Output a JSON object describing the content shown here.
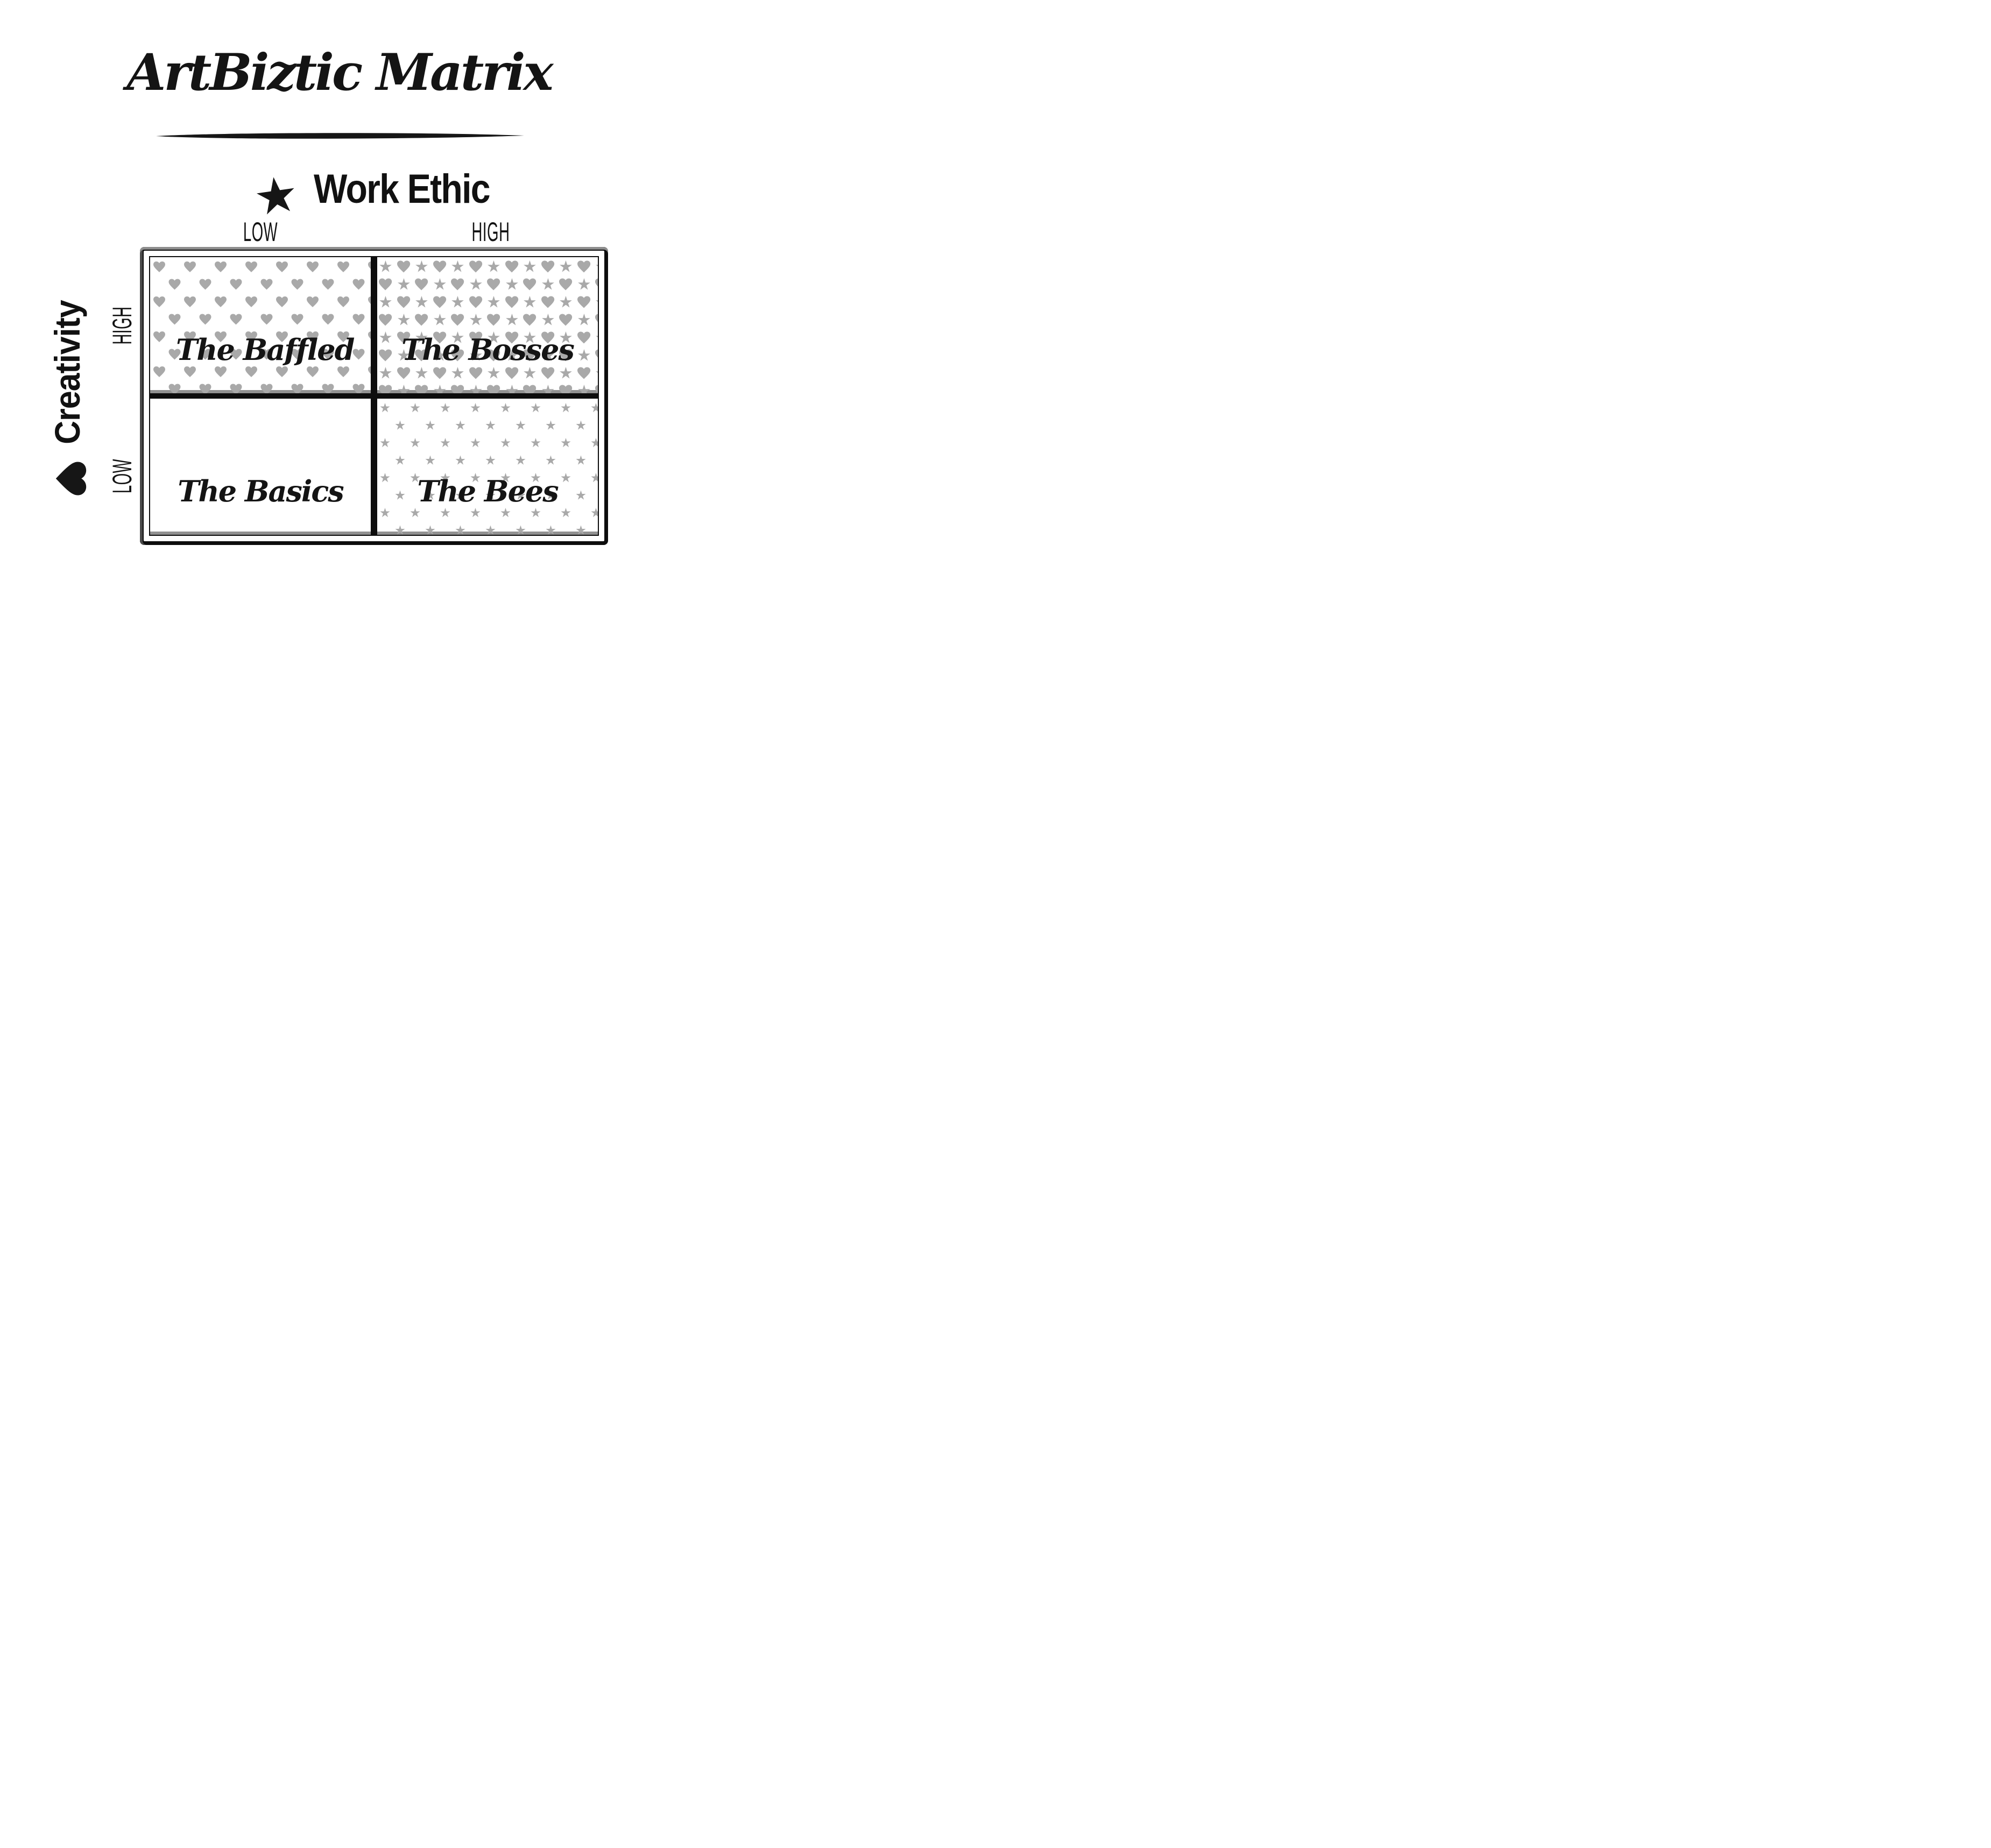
{
  "title": "ArtBiztic Matrix",
  "axes": {
    "x": {
      "title": "Work Ethic",
      "icon": "star",
      "low_label": "LOW",
      "high_label": "HIGH"
    },
    "y": {
      "title": "Creativity",
      "icon": "heart",
      "low_label": "LOW",
      "high_label": "HIGH"
    }
  },
  "quadrants": [
    {
      "name": "The Baffled",
      "position": "top-left",
      "work_ethic": "LOW",
      "creativity": "HIGH",
      "pattern": "hearts"
    },
    {
      "name": "The Bosses",
      "position": "top-right",
      "work_ethic": "HIGH",
      "creativity": "HIGH",
      "pattern": "hearts-and-stars"
    },
    {
      "name": "The Basics",
      "position": "bottom-left",
      "work_ethic": "LOW",
      "creativity": "LOW",
      "pattern": "plain"
    },
    {
      "name": "The Bees",
      "position": "bottom-right",
      "work_ethic": "HIGH",
      "creativity": "LOW",
      "pattern": "stars"
    }
  ],
  "colors": {
    "ink": "#161616",
    "frame_black": "#0d0d0d",
    "pattern_gray": "#a9a9a9",
    "shadow_gray": "#919191"
  }
}
